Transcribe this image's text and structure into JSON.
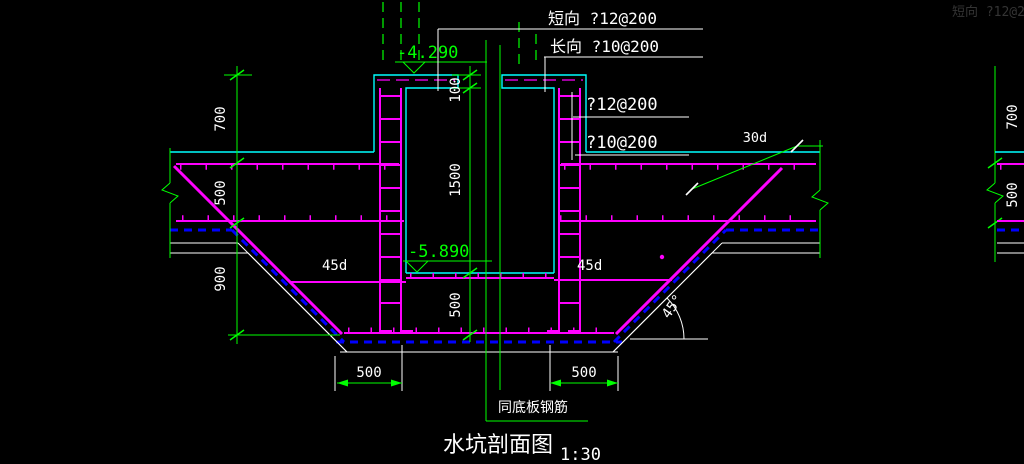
{
  "window": {
    "width": "1024",
    "height": "464"
  },
  "drawing": {
    "title": "水坑剖面图",
    "scale": "1:30",
    "labels": {
      "short_dir": "短向 ?12@200",
      "long_dir": "长向 ?10@200",
      "wall_rebar": "?12@200",
      "slab_rebar": "?10@200",
      "anchor_30d": "30d",
      "anchor_45d_left": "45d",
      "anchor_45d_right": "45d",
      "angle_45": "45°",
      "same_as_slab_note": "同底板钢筋",
      "ghost_adjacent": "短向 ?12@200"
    },
    "elevations": {
      "wall_top": "-4.290",
      "pit_bottom": "-5.890"
    },
    "dimensions": {
      "left": [
        "700",
        "500",
        "900"
      ],
      "center": [
        "100",
        "1500",
        "500"
      ],
      "bottom": [
        "500",
        "500"
      ],
      "adjacent_partial": [
        "700",
        "500"
      ]
    },
    "colors": {
      "background": "#000000",
      "rebar": "#FF00FF",
      "concrete_outline": "#00FFFF",
      "dimension": "#00FF00",
      "text": "#FFFFFF",
      "membrane": "#0000FF"
    }
  }
}
